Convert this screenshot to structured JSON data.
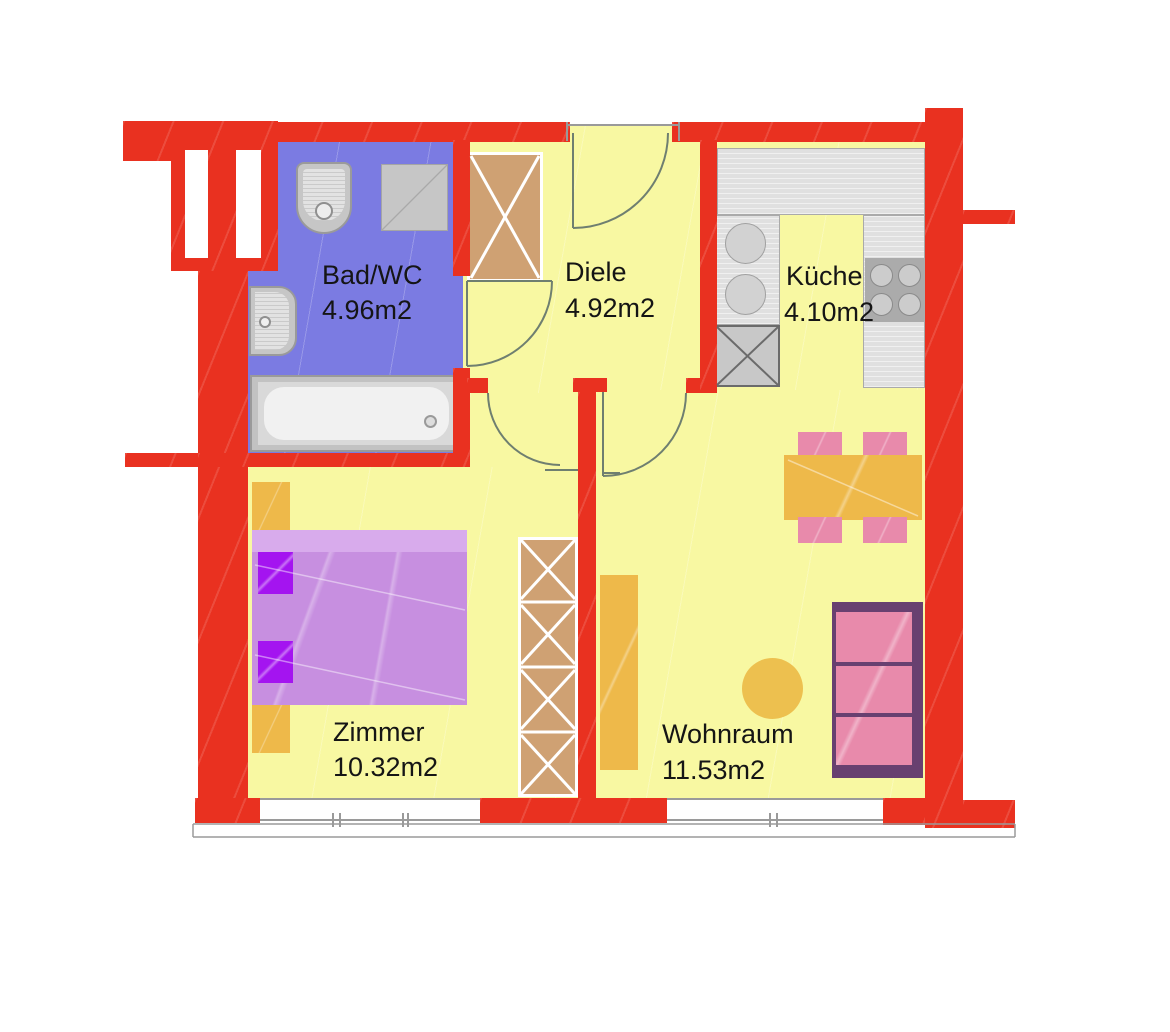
{
  "rooms": [
    {
      "id": "badwc",
      "name": "Bad/WC",
      "area": "4.96m2"
    },
    {
      "id": "diele",
      "name": "Diele",
      "area": "4.92m2"
    },
    {
      "id": "kueche",
      "name": "Küche",
      "area": "4.10m2"
    },
    {
      "id": "zimmer",
      "name": "Zimmer",
      "area": "10.32m2"
    },
    {
      "id": "wohnraum",
      "name": "Wohnraum",
      "area": "11.53m2"
    }
  ],
  "colors": {
    "wall_red": "#e93120",
    "floor_yellow": "#f8f8a2",
    "bathroom_blue": "#7b7be2",
    "cabinet_tan": "#cfa173",
    "bed_purple": "#c78fe0",
    "pillow_purple": "#a414f0",
    "furniture_orange": "#eeb94a",
    "seat_pink": "#e88aab",
    "sofa_frame_purple": "#684070",
    "counter_gray": "#e0e0e0",
    "appliance_gray": "#c8c8c8",
    "door_arc_gray": "#6f7f70"
  }
}
